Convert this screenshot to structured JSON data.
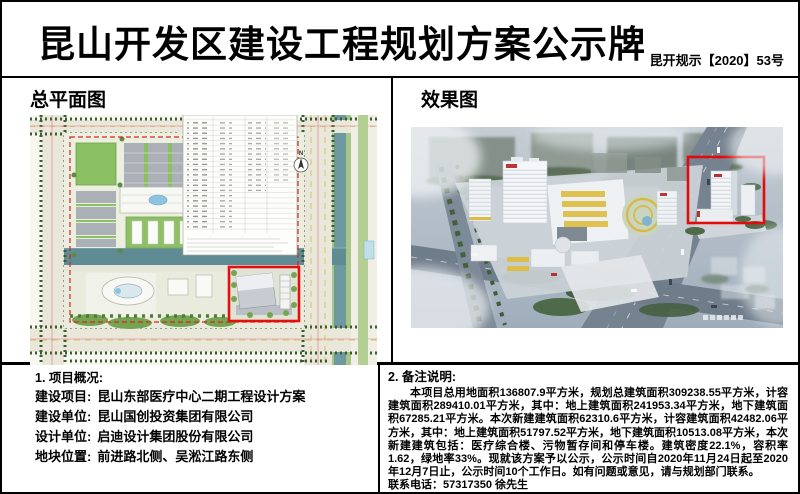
{
  "header": {
    "title": "昆山开发区建设工程规划方案公示牌",
    "doc_no": "昆开规示【2020】53号"
  },
  "site_plan": {
    "title": "总平面图",
    "north_label": "N",
    "highlight_color": "#e40f0f"
  },
  "rendering": {
    "title": "效果图",
    "highlight_color": "#e20a0a"
  },
  "overview": {
    "heading": "1. 项目概况:",
    "items": [
      {
        "label": "建设项目:",
        "value": "昆山东部医疗中心二期工程设计方案"
      },
      {
        "label": "建设单位:",
        "value": "昆山国创投资集团有限公司"
      },
      {
        "label": "设计单位:",
        "value": "启迪设计集团股份有限公司"
      },
      {
        "label": "地块位置:",
        "value": "前进路北侧、吴淞江路东侧"
      }
    ]
  },
  "remarks": {
    "heading": "2. 备注说明:",
    "body": "本项目总用地面积136807.9平方米，规划总建筑面积309238.55平方米，计容建筑面积289410.01平方米，其中：地上建筑面积241953.34平方米，地下建筑面积67285.21平方米。本次新建建筑面积62310.6平方米，计容建筑面积42482.06平方米，其中：地上建筑面积51797.52平方米，地下建筑面积10513.08平方米，本次新建建筑包括：医疗综合楼、污物暂存间和停车楼。建筑密度22.1%，容积率1.62，绿地率33%。现就该方案予以公示，公示时间自2020年11月24日起至2020年12月7日止，公示时间10个工作日。如有问题或意见，请与规划部门联系。",
    "contact": "联系电话：57317350 徐先生"
  },
  "colors": {
    "site_green": "#8abf62",
    "canal_teal": "#5f8b94",
    "road_gray": "#75828f",
    "accent_yellow": "#dcbe45",
    "highlight_red": "#e40f0f"
  }
}
